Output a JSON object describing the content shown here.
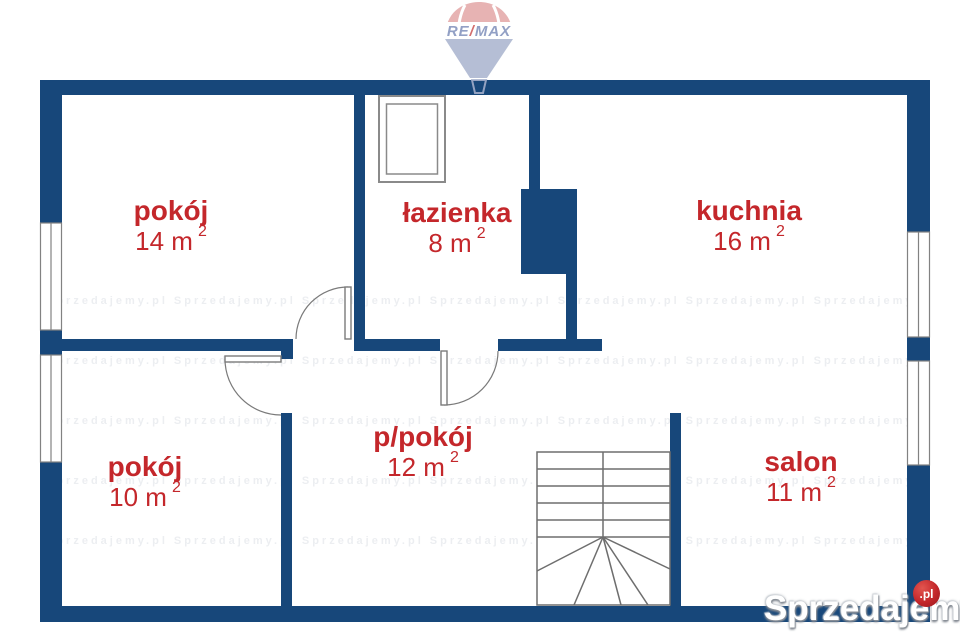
{
  "colors": {
    "wall_navy": "#17477a",
    "room_label_red": "#c4272b",
    "thin_line_gray": "#7a7a7a",
    "balloon_dome_red": "#e3a6a6",
    "balloon_cone_blue": "#a9b3ce",
    "balloon_text_blue": "#8090bb",
    "balloon_slash_red": "#cc5555",
    "watermark_badge_red": "#c3262a"
  },
  "logo_balloon": {
    "re": "RE",
    "slash": "/",
    "max": "MAX"
  },
  "rooms": [
    {
      "id": "pokoj-14",
      "name": "pokój",
      "area": "14 m",
      "sup": "2"
    },
    {
      "id": "lazienka",
      "name": "łazienka",
      "area": "8 m",
      "sup": "2"
    },
    {
      "id": "kuchnia",
      "name": "kuchnia",
      "area": "16 m",
      "sup": "2"
    },
    {
      "id": "pokoj-10",
      "name": "pokój",
      "area": "10 m",
      "sup": "2"
    },
    {
      "id": "p-pokoj",
      "name": "p/pokój",
      "area": "12 m",
      "sup": "2"
    },
    {
      "id": "salon",
      "name": "salon",
      "area": "11 m",
      "sup": "2"
    }
  ],
  "watermark": {
    "brand": "Sprzedajemy",
    "badge": ".pl",
    "tiled_row": "Sprzedajemy.pl      Sprzedajemy.pl      Sprzedajemy.pl      Sprzedajemy.pl      Sprzedajemy.pl      Sprzedajemy.pl      Sprzedajemy.pl      Sprzedajemy.pl"
  }
}
